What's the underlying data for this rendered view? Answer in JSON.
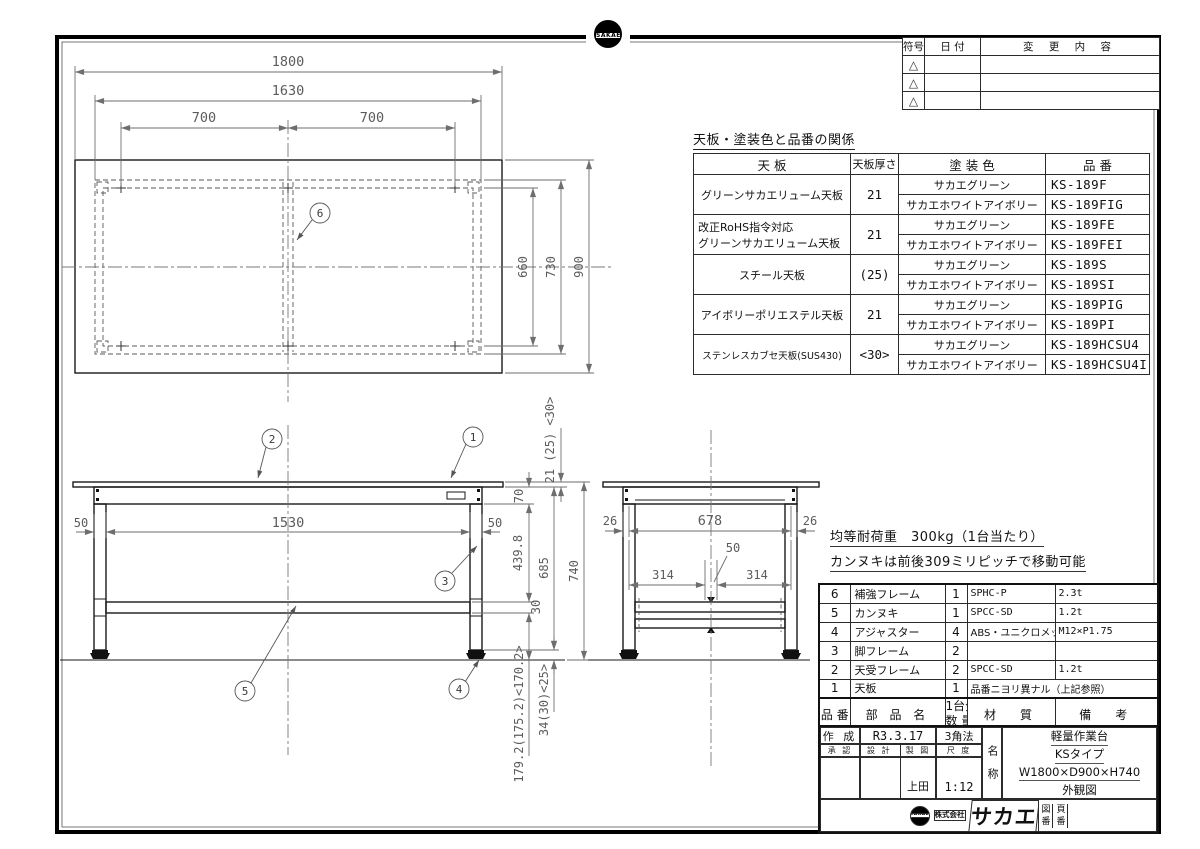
{
  "colors": {
    "line": "#1a1a1a",
    "dim": "#6e6e6e",
    "bg": "#ffffff"
  },
  "icons": {
    "sakae_logo": "SAKAE",
    "revision_mark": "△"
  },
  "revision_table": {
    "headers": [
      "符号",
      "日 付",
      "変 更 内 容"
    ],
    "rows": [
      {
        "mark": "△"
      },
      {
        "mark": "△"
      },
      {
        "mark": "△"
      }
    ]
  },
  "product_table": {
    "title": "天板・塗装色と品番の関係",
    "headers": {
      "top": "天 板",
      "thickness": "天板厚さ",
      "color": "塗 装 色",
      "part_no": "品 番"
    },
    "groups": [
      {
        "name": "グリーンサカエリューム天板",
        "name2": "",
        "thickness": "21",
        "variants": [
          {
            "color": "サカエグリーン",
            "part_no": "KS-189F"
          },
          {
            "color": "サカエホワイトアイボリー",
            "part_no": "KS-189FIG"
          }
        ]
      },
      {
        "name": "改正RoHS指令対応",
        "name2": "グリーンサカエリューム天板",
        "thickness": "21",
        "variants": [
          {
            "color": "サカエグリーン",
            "part_no": "KS-189FE"
          },
          {
            "color": "サカエホワイトアイボリー",
            "part_no": "KS-189FEI"
          }
        ]
      },
      {
        "name": "スチール天板",
        "name2": "",
        "thickness": "(25)",
        "variants": [
          {
            "color": "サカエグリーン",
            "part_no": "KS-189S"
          },
          {
            "color": "サカエホワイトアイボリー",
            "part_no": "KS-189SI"
          }
        ]
      },
      {
        "name": "アイボリーポリエステル天板",
        "name2": "",
        "thickness": "21",
        "variants": [
          {
            "color": "サカエグリーン",
            "part_no": "KS-189PIG"
          },
          {
            "color": "サカエホワイトアイボリー",
            "part_no": "KS-189PI"
          }
        ]
      },
      {
        "name": "ステンレスカブセ天板(SUS430)",
        "name2": "",
        "thickness": "<30>",
        "variants": [
          {
            "color": "サカエグリーン",
            "part_no": "KS-189HCSU4"
          },
          {
            "color": "サカエホワイトアイボリー",
            "part_no": "KS-189HCSU4I"
          }
        ]
      }
    ]
  },
  "notes": [
    "均等耐荷重　300kg（1台当たり）",
    "カンヌキは前後309ミリピッチで移動可能"
  ],
  "parts_table": {
    "headers": {
      "no": "品 番",
      "name": "部 品 名",
      "qty_top": "1台分",
      "qty_bottom": "数 量",
      "material": "材　質",
      "remarks": "備　考"
    },
    "rows": [
      {
        "no": "6",
        "name": "補強フレーム",
        "qty": "1",
        "material": "SPHC-P",
        "remarks": "2.3t"
      },
      {
        "no": "5",
        "name": "カンヌキ",
        "qty": "1",
        "material": "SPCC-SD",
        "remarks": "1.2t"
      },
      {
        "no": "4",
        "name": "アジャスター",
        "qty": "4",
        "material": "ABS・ユニクロメッキ",
        "remarks": "M12×P1.75"
      },
      {
        "no": "3",
        "name": "脚フレーム",
        "qty": "2",
        "material": "",
        "remarks": ""
      },
      {
        "no": "2",
        "name": "天受フレーム",
        "qty": "2",
        "material": "SPCC-SD",
        "remarks": "1.2t"
      },
      {
        "no": "1",
        "name": "天板",
        "qty": "1",
        "material": "品番ニヨリ異ナル（上記参照）",
        "remarks": ""
      }
    ]
  },
  "title_block": {
    "created_label": "作 成",
    "created_value": "R3.3.17",
    "projection": "3角法",
    "approve_label": "承 認",
    "design_label": "設 計",
    "draft_label": "製 図",
    "scale_label": "尺 度",
    "draft_value": "上田",
    "scale_value": "1:12",
    "name_label": "名称",
    "product_lines": [
      "軽量作業台",
      "KSタイプ",
      "W1800×D900×H740",
      "外観図"
    ],
    "company_prefix_top": "株式",
    "company_prefix_bottom": "会社",
    "company_name": "サカエ",
    "drawing_no_label": "図番",
    "page_no_label": "頁番"
  },
  "drawing": {
    "balloons": {
      "b1": "1",
      "b2": "2",
      "b3": "3",
      "b4": "4",
      "b5": "5",
      "b6": "6"
    },
    "top_view": {
      "width": "1800",
      "frame_width": "1630",
      "pitch_left": "700",
      "pitch_right": "700",
      "inner_depth": "660",
      "frame_depth": "730",
      "depth": "900",
      "top_thickness": "21 (25) <30>"
    },
    "front_view": {
      "leg_width_left": "50",
      "leg_span": "1530",
      "leg_width_right": "50",
      "apron_height": "70",
      "rail_drop": "439.8",
      "rail_height": "30",
      "underside_height": "685",
      "height": "740",
      "foot_range": "34(30)<25>",
      "lower_clearance": "179.2(175.2)<170.2>"
    },
    "side_view": {
      "offset_left": "26",
      "inner_span": "678",
      "offset_right": "26",
      "pitch_left": "314",
      "pitch_right": "314",
      "rail_width": "50"
    }
  }
}
